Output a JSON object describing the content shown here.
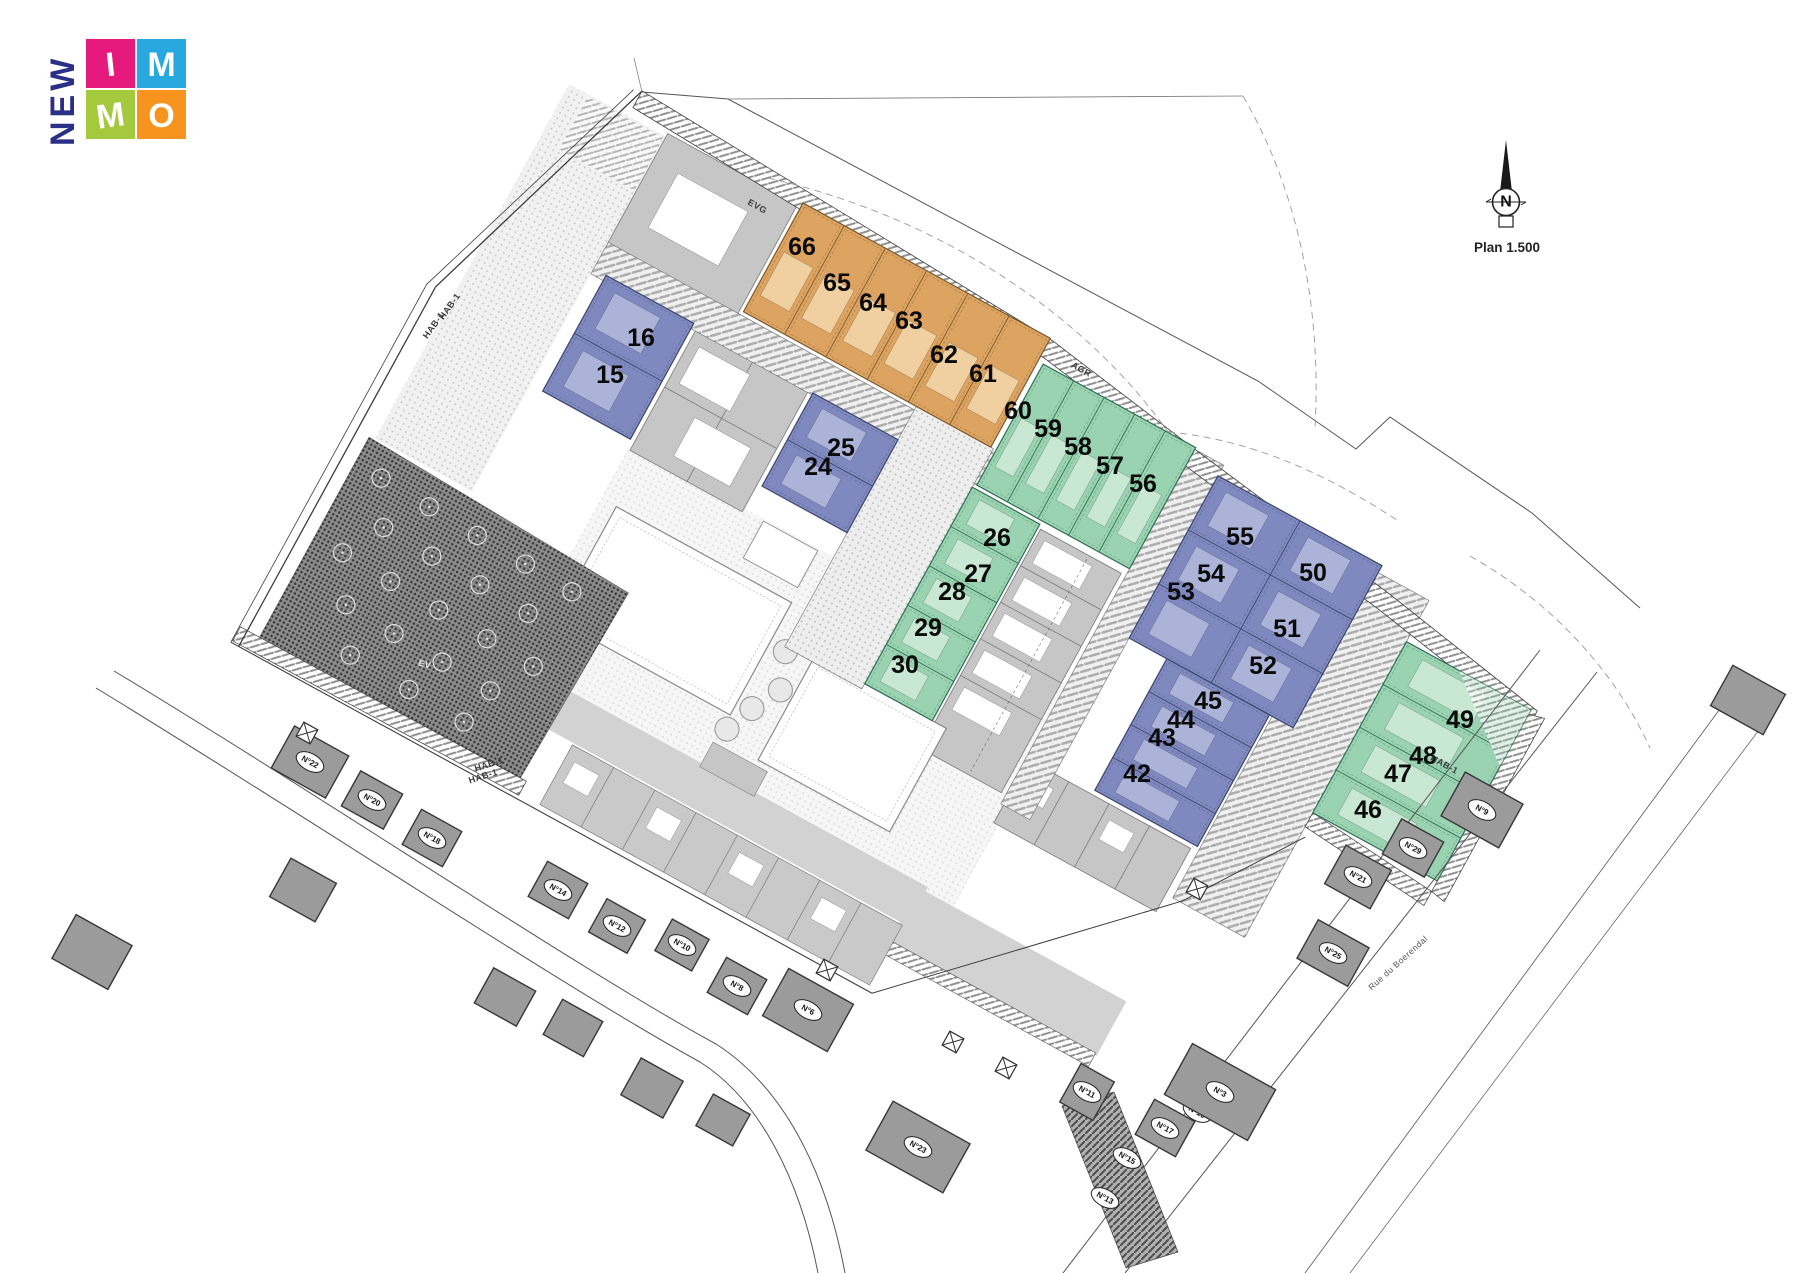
{
  "logo": {
    "vertical_text": "NEW",
    "navy": "#2b3087",
    "squares": [
      {
        "letter": "I",
        "color": "#e6197d"
      },
      {
        "letter": "M",
        "color": "#29a8e0"
      },
      {
        "letter": "M",
        "color": "#a5c93c"
      },
      {
        "letter": "O",
        "color": "#f7941e"
      }
    ]
  },
  "compass": {
    "north_label": "N",
    "scale_label": "Plan 1.500"
  },
  "zones": {
    "agr_label": "AGR",
    "hab_label": "HAB-1",
    "ev_label": "EV",
    "evg_label": "EVG",
    "street_name": "Rue du Boerendal"
  },
  "lot_groups": [
    {
      "name": "terraced-north",
      "color_name": "orange",
      "fill": "#dda361",
      "building_fill": "#f0cfa0",
      "edge": "#7c5a2e",
      "lots": [
        "66",
        "65",
        "64",
        "63",
        "62",
        "61"
      ]
    },
    {
      "name": "north-green",
      "color_name": "green",
      "fill": "#99d3b1",
      "building_fill": "#c9e8d4",
      "edge": "#2f6f52",
      "lots": [
        "60",
        "59",
        "58",
        "57",
        "56"
      ]
    },
    {
      "name": "west-blue",
      "color_name": "blue",
      "fill": "#8089bf",
      "building_fill": "#abb4d8",
      "edge": "#39466f",
      "lots": [
        "16",
        "15"
      ]
    },
    {
      "name": "mid-blue",
      "color_name": "blue",
      "fill": "#8089bf",
      "building_fill": "#abb4d8",
      "edge": "#39466f",
      "lots": [
        "25",
        "24"
      ]
    },
    {
      "name": "mid-green",
      "color_name": "green",
      "fill": "#99d3b1",
      "building_fill": "#c9e8d4",
      "edge": "#2f6f52",
      "lots": [
        "26",
        "27",
        "28",
        "29",
        "30"
      ]
    },
    {
      "name": "east-blue",
      "color_name": "blue",
      "fill": "#8089bf",
      "building_fill": "#abb4d8",
      "edge": "#39466f",
      "lots": [
        "55",
        "50",
        "54",
        "51",
        "53",
        "52"
      ]
    },
    {
      "name": "south-blue",
      "color_name": "blue",
      "fill": "#8089bf",
      "building_fill": "#abb4d8",
      "edge": "#39466f",
      "lots": [
        "45",
        "44",
        "43",
        "42"
      ]
    },
    {
      "name": "east-green",
      "color_name": "green",
      "fill": "#99d3b1",
      "building_fill": "#c9e8d4",
      "edge": "#2f6f52",
      "lots": [
        "49",
        "48",
        "47",
        "46"
      ]
    }
  ],
  "existing_houses": [
    "N°22",
    "N°20",
    "N°18",
    "N°14",
    "N°12",
    "N°10",
    "N°8",
    "N°6",
    "N°23",
    "N°11",
    "N°17",
    "N°19",
    "N°3",
    "N°15",
    "N°13",
    "N°9",
    "N°29",
    "N°21",
    "N°25"
  ]
}
